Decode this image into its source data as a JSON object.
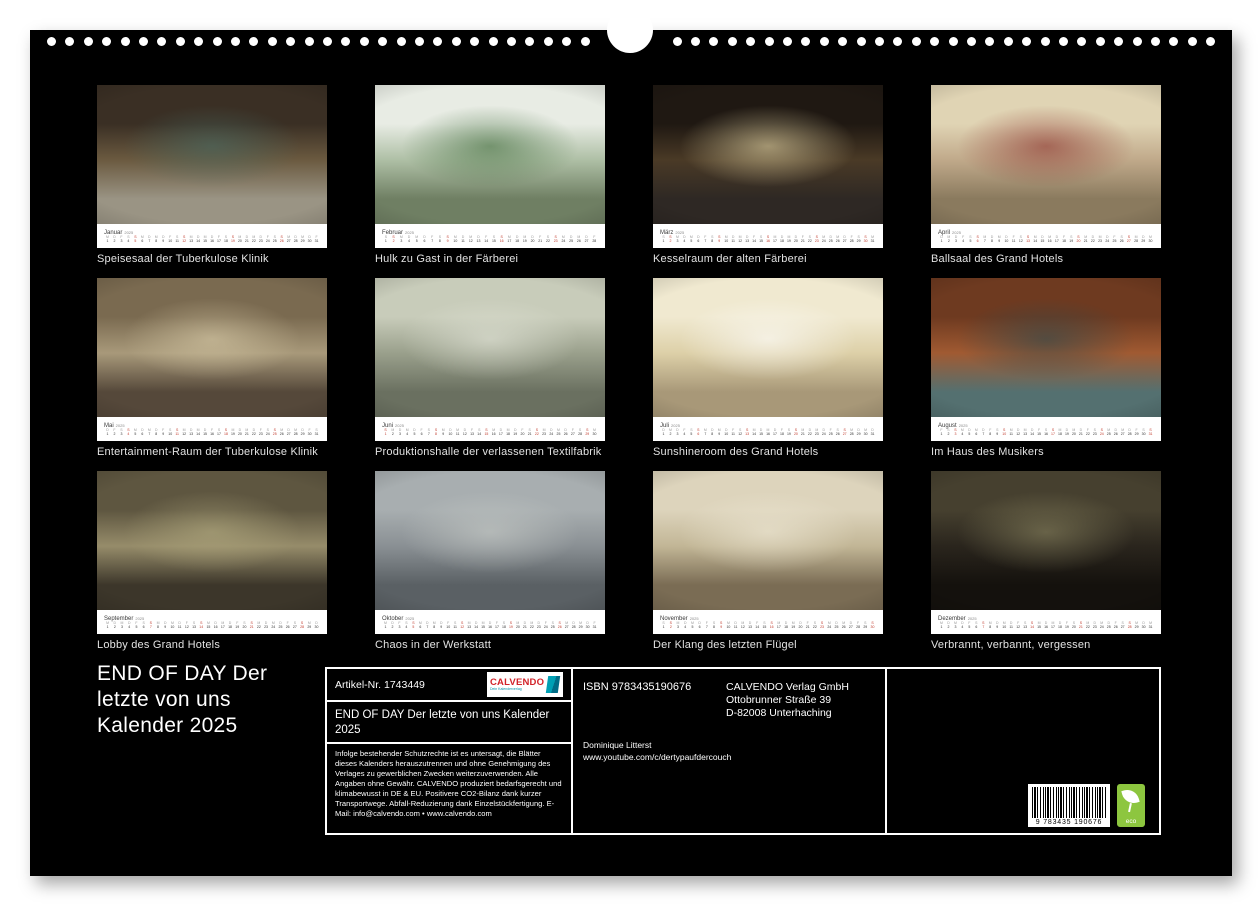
{
  "page": {
    "background": "#000000",
    "paper": "#ffffff",
    "year": "2025"
  },
  "binding": {
    "dot_color": "#ffffff"
  },
  "weekday_letters": [
    "M",
    "D",
    "M",
    "D",
    "F",
    "S",
    "S"
  ],
  "months": [
    {
      "label": "Januar",
      "year": "2025",
      "caption": "Speisesaal der Tuberkulose Klinik",
      "days": 31,
      "start_dow": 2,
      "palette": [
        "#3a2f24",
        "#6b5a40",
        "#9a9484"
      ],
      "accent": "#4a6b63"
    },
    {
      "label": "Februar",
      "year": "2025",
      "caption": "Hulk zu Gast in der Färberei",
      "days": 28,
      "start_dow": 5,
      "palette": [
        "#e8ece4",
        "#aebfa5",
        "#6f7f63"
      ],
      "accent": "#3f6b3a"
    },
    {
      "label": "März",
      "year": "2025",
      "caption": "Kesselraum der alten Färberei",
      "days": 31,
      "start_dow": 5,
      "palette": [
        "#1f1812",
        "#4a3a26",
        "#2e2824"
      ],
      "accent": "#e8d9a8"
    },
    {
      "label": "April",
      "year": "2025",
      "caption": "Ballsaal des Grand Hotels",
      "days": 30,
      "start_dow": 1,
      "palette": [
        "#e0d4b4",
        "#c0a98a",
        "#8a7a5e"
      ],
      "accent": "#8a2f2a"
    },
    {
      "label": "Mai",
      "year": "2025",
      "caption": "Entertainment-Raum der Tuberkulose Klinik",
      "days": 31,
      "start_dow": 3,
      "palette": [
        "#7a6a50",
        "#a8997a",
        "#55483a"
      ],
      "accent": "#d8cba8"
    },
    {
      "label": "Juni",
      "year": "2025",
      "caption": "Produktionshalle der verlassenen Textilfabrik",
      "days": 30,
      "start_dow": 6,
      "palette": [
        "#c8ccba",
        "#9aa08c",
        "#6a7060"
      ],
      "accent": "#e4e6da"
    },
    {
      "label": "Juli",
      "year": "2025",
      "caption": "Sunshineroom des Grand Hotels",
      "days": 31,
      "start_dow": 1,
      "palette": [
        "#f0e9d0",
        "#ddd0a8",
        "#a89878"
      ],
      "accent": "#ffffff"
    },
    {
      "label": "August",
      "year": "2025",
      "caption": "Im Haus des Musikers",
      "days": 31,
      "start_dow": 4,
      "palette": [
        "#6e3a20",
        "#a05a32",
        "#547070"
      ],
      "accent": "#2e4a4e"
    },
    {
      "label": "September",
      "year": "2025",
      "caption": "Lobby des Grand Hotels",
      "days": 30,
      "start_dow": 0,
      "palette": [
        "#5e5640",
        "#968c6a",
        "#3c362a"
      ],
      "accent": "#b0a87e"
    },
    {
      "label": "Oktober",
      "year": "2025",
      "caption": "Chaos in der Werkstatt",
      "days": 31,
      "start_dow": 2,
      "palette": [
        "#a8aeb0",
        "#8a9094",
        "#5a6064"
      ],
      "accent": "#c8ccc8"
    },
    {
      "label": "November",
      "year": "2025",
      "caption": "Der Klang des letzten Flügel",
      "days": 30,
      "start_dow": 5,
      "palette": [
        "#ddd4bc",
        "#c2b696",
        "#7a6c54"
      ],
      "accent": "#f0ead8"
    },
    {
      "label": "Dezember",
      "year": "2025",
      "caption": "Verbrannt, verbannt, vergessen",
      "days": 31,
      "start_dow": 0,
      "palette": [
        "#46402f",
        "#2a251d",
        "#14110d"
      ],
      "accent": "#8a8460"
    }
  ],
  "footer": {
    "title_lines": [
      "END OF DAY  Der",
      "letzte von uns",
      "Kalender 2025"
    ],
    "artikel_label": "Artikel-Nr. 1743449",
    "logo": {
      "name": "CALVENDO",
      "tagline": "Dein Kalenderverlag",
      "red": "#d2232a",
      "teal": "#0090a8"
    },
    "product_title": "END OF DAY  Der letzte von uns  Kalender 2025",
    "legal": "Infolge bestehender Schutzrechte ist es untersagt, die Blätter dieses Kalenders herauszutrennen und ohne Genehmigung des Verlages zu gewerblichen Zwecken weiterzuverwenden. Alle Angaben ohne Gewähr. CALVENDO produziert bedarfsgerecht und klimabewusst in DE & EU. Positivere CO2-Bilanz dank kurzer Transportwege. Abfall-Reduzierung dank Einzelstückfertigung. E-Mail: info@calvendo.com • www.calvendo.com",
    "isbn": "ISBN 9783435190676",
    "publisher_lines": [
      "CALVENDO Verlag GmbH",
      "Ottobrunner Straße 39",
      "D-82008 Unterhaching"
    ],
    "author": "Dominique Litterst",
    "author_url": "www.youtube.com/c/dertypaufdercouch",
    "barcode_digits": "9 783435 190676",
    "eco_label": "eco",
    "eco_color": "#8dc63f"
  }
}
